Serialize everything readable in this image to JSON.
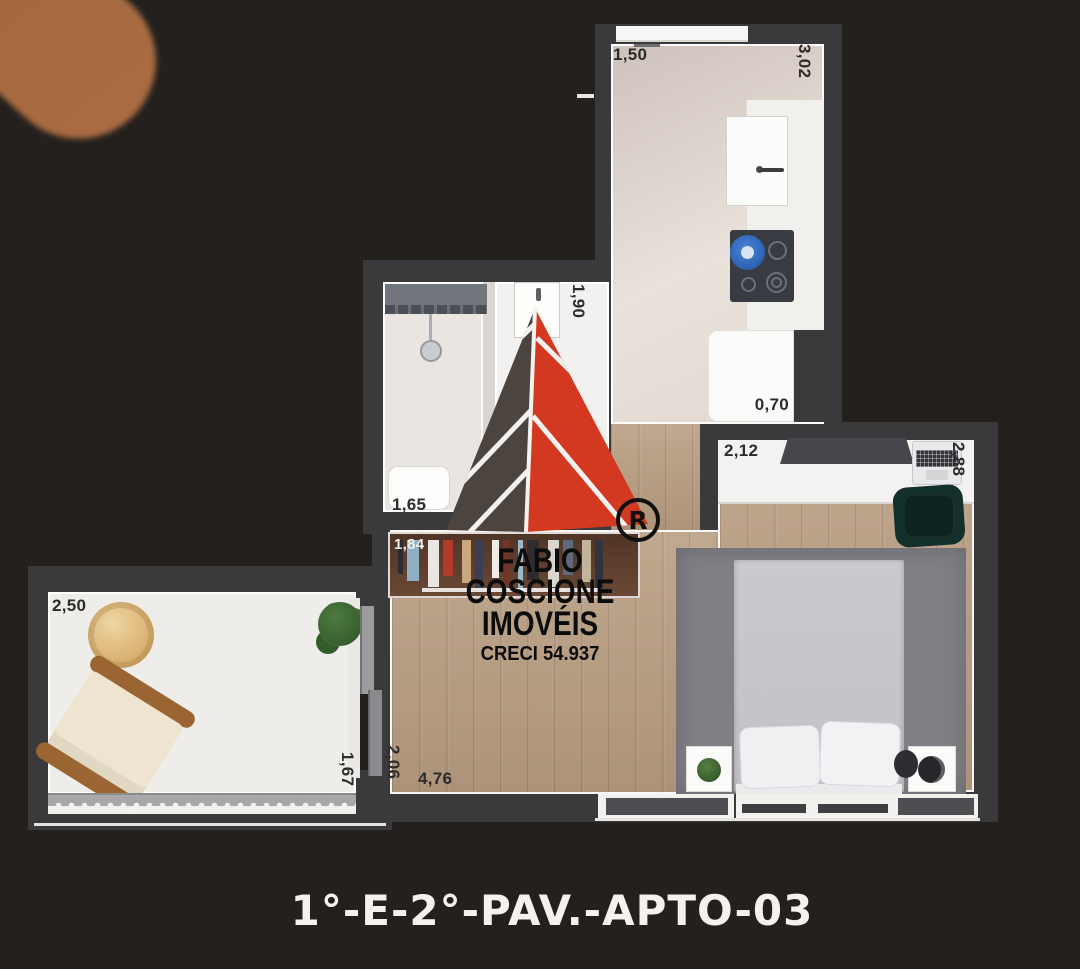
{
  "caption": "1°-E-2°-PAV.-APTO-03",
  "watermark": {
    "line1": "FABIO COSCIONE",
    "line2": "IMOVÉIS",
    "line3": "CRECI 54.937",
    "registered": "R"
  },
  "dims": {
    "kitchen_window_w": "1,50",
    "kitchen_h": "3,02",
    "fridge_w": "0,70",
    "entry_h": "1,90",
    "bath_w": "1,65",
    "closet_w": "1,84",
    "partial_h": "98",
    "desk_w": "2,12",
    "bedroom_h": "2,88",
    "balcony_w": "2,50",
    "balcony_h": "1,67",
    "living_h": "2,06",
    "living_w": "4,76"
  },
  "closet": {
    "clothes_colors": [
      "#2e2a33",
      "#8fb0c4",
      "#e8e6e2",
      "#b23a28",
      "#caa87e",
      "#3a3f52",
      "#efece8",
      "#743428",
      "#9db8c8",
      "#2f2b2e",
      "#d9d5cf",
      "#5d6a7e",
      "#c2b49a",
      "#30343f"
    ]
  },
  "colors": {
    "background": "#24201d",
    "wall": "#3a393c",
    "wood_floor": "#b79c80",
    "kitchen_floor": "#e0d6cf",
    "balcony_floor": "#efede9",
    "logo_red": "#d23920",
    "logo_dark": "#4c443e",
    "caption_text": "#f4f2ee",
    "dim_text": "#2d2b2c"
  }
}
